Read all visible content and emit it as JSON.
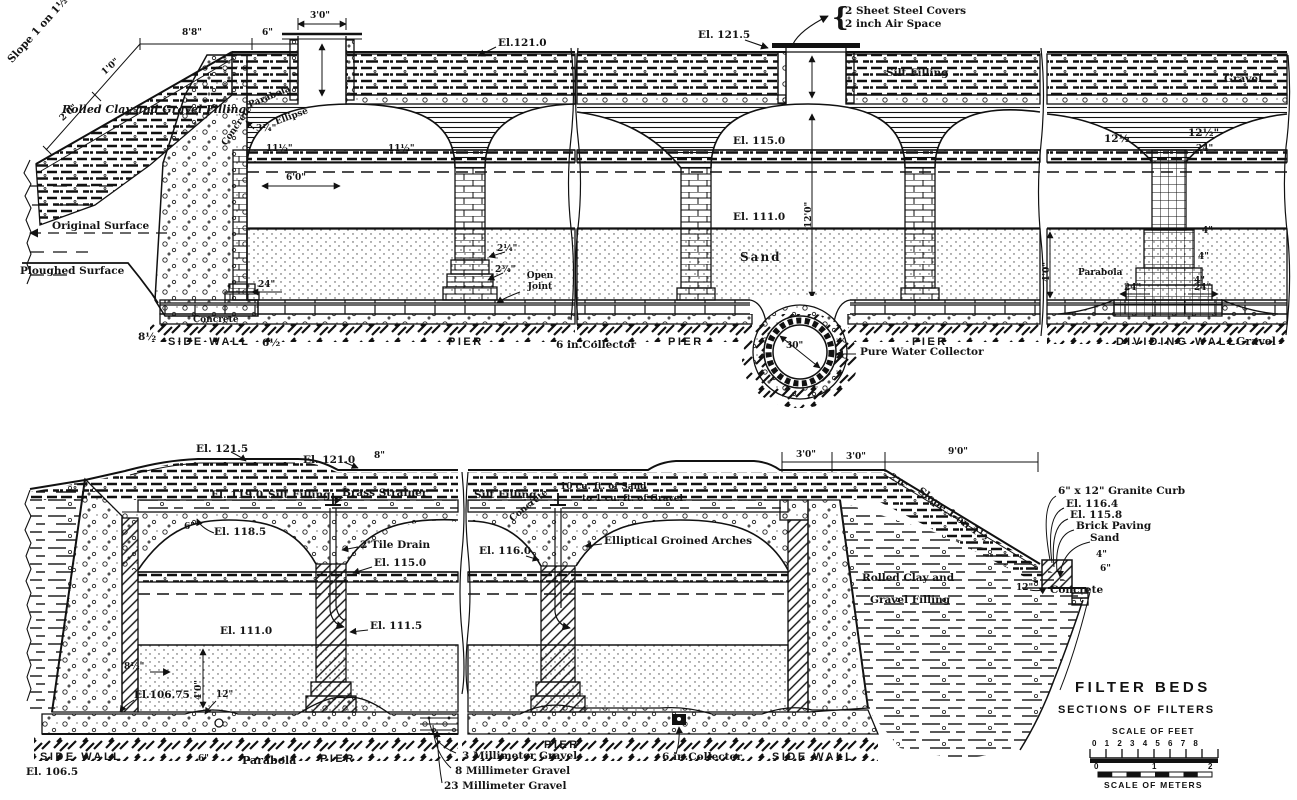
{
  "common": {
    "pier": "PIER",
    "side_wall": "SIDE WALL",
    "dividing_wall": "DIVIDING WALL",
    "parabola": "Parabola",
    "ellipse": "Ellipse",
    "concrete": "Concrete",
    "sand": "Sand",
    "gravel": "Gravel",
    "silt_filling": "Silt Filling",
    "collector_6in": "6 in.Collector",
    "slope": "Slope 1 on 1½",
    "open_joint": "Open Joint"
  },
  "top": {
    "el_121_0": "El.121.0",
    "el_121_5": "El. 121.5",
    "el_115_0": "El. 115.0",
    "el_111_0": "El. 111.0",
    "covers_brace": "{",
    "covers_line1": "2 Sheet Steel Covers",
    "covers_line2": "2 inch Air Space",
    "rolled_clay": "Rolled Clay and Gravel Filling",
    "original_surface": "Original Surface",
    "ploughed_surface": "Ploughed Surface",
    "pure_water_collector": "Pure Water Collector",
    "dim_30": "30\"",
    "dim_2_0": "2'0\"",
    "dim_1_0": "1'0\"",
    "dim_8_8": "8'8\"",
    "dim_6": "6\"",
    "dim_3_0": "3'0\"",
    "dim_3_25": "3¼\"",
    "dim_11_5": "11½\"",
    "dim_6_0": "6'0\"",
    "dim_12_0": "12'0\"",
    "dim_4_0": "4'0\"",
    "dim_24": "24\"",
    "dim_8_5": "8½",
    "dim_6_5": "6½",
    "dim_2_25": "2¼\"",
    "dim_2_75": "2¾\"",
    "dim_12_5": "12½",
    "dim_12_5b": "12½\"",
    "dim_24b": "24\"",
    "dim_4": "4\""
  },
  "bottom": {
    "el_121_5": "El. 121.5",
    "el_121_0": "El. 121.0",
    "dim_8": "8\"",
    "el_119_0": "El. 119.0",
    "brass_strainer": "Brass Strainer",
    "dim_6": "6\"",
    "el_118_5": "El. 118.5",
    "tile_drain": "2 Tile Drain",
    "el_115_0": "El. 115.0",
    "el_111_0": "El. 111.0",
    "el_111_5": "El. 111.5",
    "dim_4_0": "4'0\"",
    "dim_8_5": "8½\"",
    "el_106_75": "El.106.75",
    "dim_12": "12\"",
    "el_106_5": "El. 106.5",
    "gravel_3mm": "3 Millimeter Gravel",
    "gravel_8mm": "8 Millimeter Gravel",
    "gravel_23mm": "23 Millimeter Gravel",
    "ratio_line1": "10 cu. ft. of Sand",
    "ratio_line2": "to 1 cu. ft. of Gravel",
    "groined_arches": "Elliptical Groined Arches",
    "el_116_0": "El. 116.0",
    "dim_3_0": "3'0\"",
    "dim_9_0": "9'0\"",
    "dim_2_0": "2'0\"",
    "granite_curb": "6\" x 12\" Granite Curb",
    "el_116_4": "El. 116.4",
    "el_115_8": "El. 115.8",
    "brick_paving": "Brick Paving",
    "dim_4": "4\"",
    "dim_12_curb": "12\"",
    "rolled_clay_line1": "Rolled Clay and",
    "rolled_clay_line2": "Gravel Filling"
  },
  "title_block": {
    "title": "FILTER BEDS",
    "subtitle": "SECTIONS OF FILTERS",
    "scale_feet_label": "SCALE OF FEET",
    "scale_feet_numbers": "0 1 2 3 4 5 6 7 8",
    "meter_0": "0",
    "meter_1": "1",
    "meter_2": "2",
    "scale_meters_label": "SCALE OF METERS"
  }
}
